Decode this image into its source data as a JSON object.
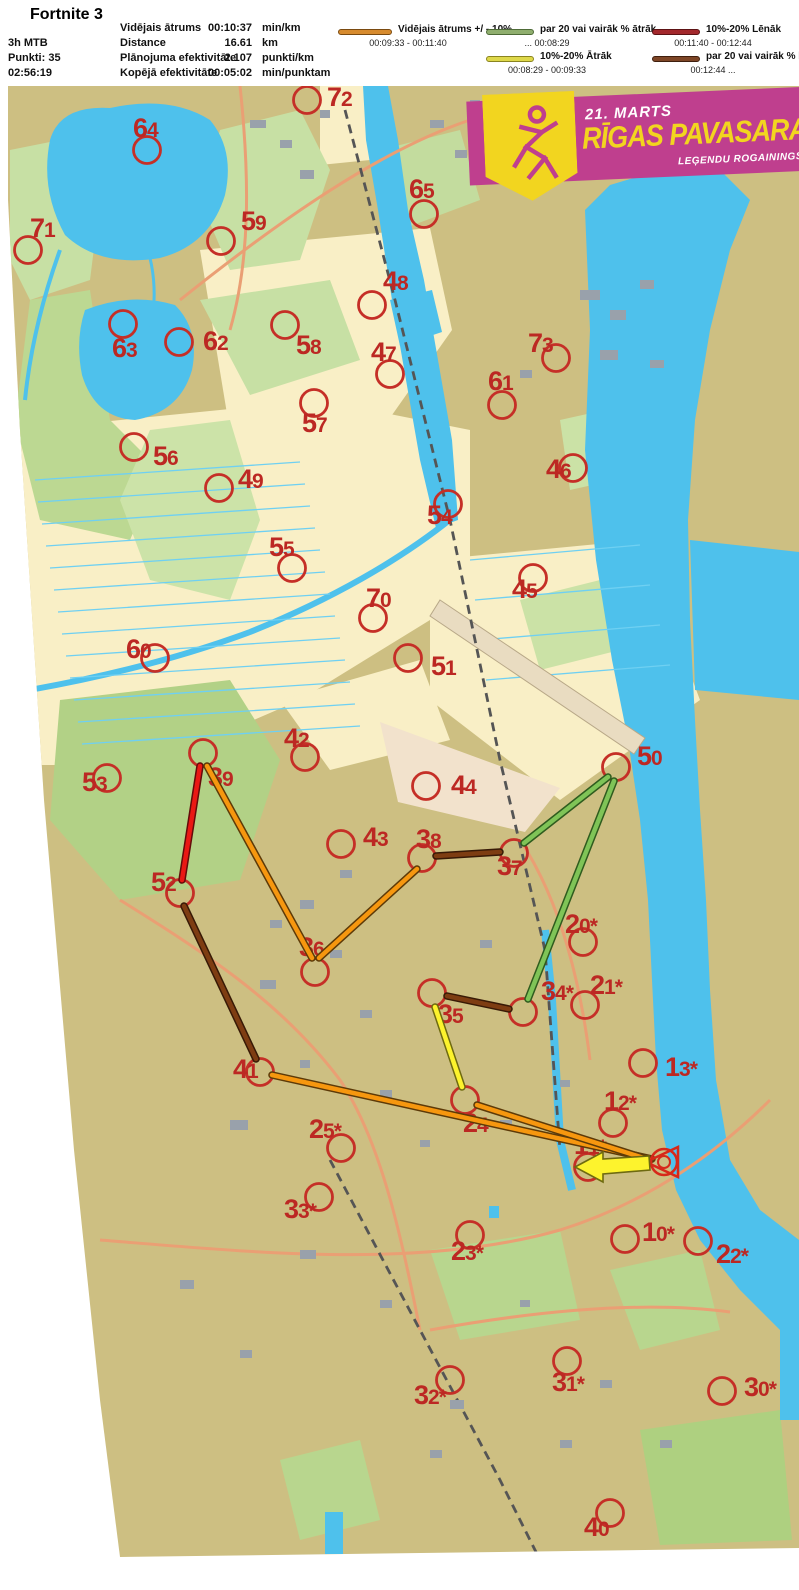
{
  "title": "Fortnite 3",
  "header": {
    "class": "3h MTB",
    "points": "Punkti: 35",
    "time": "02:56:19",
    "stats": [
      {
        "label": "Vidējais ātrums",
        "value": "00:10:37",
        "unit": "min/km"
      },
      {
        "label": "Distance",
        "value": "16.61",
        "unit": "km"
      },
      {
        "label": "Plānojuma efektivitāte",
        "value": "2.107",
        "unit": "punkti/km"
      },
      {
        "label": "Kopējā efektivitāte",
        "value": "00:05:02",
        "unit": "min/punktam"
      }
    ],
    "legend": [
      {
        "label": "Vidējais ātrums +/ - 10%",
        "range": "00:09:33   -   00:11:40",
        "color": "#d78b2e",
        "outline": "#7a4a10"
      },
      {
        "label": "par 20 vai vairāk % ātrāk",
        "range": "...    00:08:29",
        "color": "#8fae6e",
        "outline": "#4e6b37"
      },
      {
        "label": "10%-20% Ātrāk",
        "range": "00:08:29   -   00:09:33",
        "color": "#ded84a",
        "outline": "#8a8420"
      },
      {
        "label": "10%-20% Lēnāk",
        "range": "00:11:40   -   00:12:44",
        "color": "#a3282c",
        "outline": "#5d1214"
      },
      {
        "label": "par 20 vai vairāk % lēnāk",
        "range": "00:12:44    ...",
        "color": "#7d4526",
        "outline": "#3f1f0e"
      }
    ]
  },
  "banner": {
    "date": "21. MARTS",
    "title": "RĪGAS PAVASARA",
    "subtitle": "LEĢENDU ROGAININGS",
    "bg": "#bf3f8e",
    "accent": "#f2d51f"
  },
  "map": {
    "colors": {
      "control": "#c52f27",
      "label": "#bc2823"
    },
    "route_colors": {
      "avg": {
        "fill": "#f6970f",
        "edge": "#5d3a08"
      },
      "fast20": {
        "fill": "#7fc457",
        "edge": "#2f5c1e"
      },
      "fast10": {
        "fill": "#fdf32d",
        "edge": "#6e6a10"
      },
      "slow10": {
        "fill": "#ea1814",
        "edge": "#640b0a"
      },
      "slow20": {
        "fill": "#7e3d12",
        "edge": "#381a06"
      }
    },
    "controls": [
      {
        "id": "72",
        "cx": 307,
        "cy": 100,
        "lx": 327,
        "ly": 106
      },
      {
        "id": "64",
        "cx": 147,
        "cy": 150,
        "lx": 133,
        "ly": 137
      },
      {
        "id": "65",
        "cx": 424,
        "cy": 214,
        "lx": 409,
        "ly": 198
      },
      {
        "id": "71",
        "cx": 28,
        "cy": 250,
        "lx": 30,
        "ly": 237
      },
      {
        "id": "59",
        "cx": 221,
        "cy": 241,
        "lx": 241,
        "ly": 230
      },
      {
        "id": "48",
        "cx": 372,
        "cy": 305,
        "lx": 383,
        "ly": 290
      },
      {
        "id": "63",
        "cx": 123,
        "cy": 324,
        "lx": 112,
        "ly": 357
      },
      {
        "id": "62",
        "cx": 179,
        "cy": 342,
        "lx": 203,
        "ly": 350
      },
      {
        "id": "58",
        "cx": 285,
        "cy": 325,
        "lx": 296,
        "ly": 354
      },
      {
        "id": "47",
        "cx": 390,
        "cy": 374,
        "lx": 371,
        "ly": 361
      },
      {
        "id": "73",
        "cx": 556,
        "cy": 358,
        "lx": 528,
        "ly": 352
      },
      {
        "id": "61",
        "cx": 502,
        "cy": 405,
        "lx": 488,
        "ly": 390
      },
      {
        "id": "57",
        "cx": 314,
        "cy": 403,
        "lx": 302,
        "ly": 432
      },
      {
        "id": "56",
        "cx": 134,
        "cy": 447,
        "lx": 153,
        "ly": 465
      },
      {
        "id": "49",
        "cx": 219,
        "cy": 488,
        "lx": 238,
        "ly": 488
      },
      {
        "id": "46",
        "cx": 573,
        "cy": 468,
        "lx": 546,
        "ly": 478
      },
      {
        "id": "54",
        "cx": 448,
        "cy": 504,
        "lx": 427,
        "ly": 524
      },
      {
        "id": "55",
        "cx": 292,
        "cy": 568,
        "lx": 269,
        "ly": 556
      },
      {
        "id": "45",
        "cx": 533,
        "cy": 578,
        "lx": 512,
        "ly": 598
      },
      {
        "id": "70",
        "cx": 373,
        "cy": 618,
        "lx": 366,
        "ly": 607
      },
      {
        "id": "60",
        "cx": 155,
        "cy": 658,
        "lx": 126,
        "ly": 658
      },
      {
        "id": "51",
        "cx": 408,
        "cy": 658,
        "lx": 431,
        "ly": 675
      },
      {
        "id": "42",
        "cx": 305,
        "cy": 757,
        "lx": 284,
        "ly": 747
      },
      {
        "id": "50",
        "cx": 616,
        "cy": 767,
        "lx": 637,
        "ly": 765
      },
      {
        "id": "53",
        "cx": 107,
        "cy": 778,
        "lx": 82,
        "ly": 791
      },
      {
        "id": "39",
        "cx": 203,
        "cy": 753,
        "lx": 208,
        "ly": 786
      },
      {
        "id": "44",
        "cx": 426,
        "cy": 786,
        "lx": 451,
        "ly": 794
      },
      {
        "id": "43",
        "cx": 341,
        "cy": 844,
        "lx": 363,
        "ly": 846
      },
      {
        "id": "38",
        "cx": 422,
        "cy": 858,
        "lx": 416,
        "ly": 848
      },
      {
        "id": "37",
        "cx": 514,
        "cy": 853,
        "lx": 497,
        "ly": 875
      },
      {
        "id": "52",
        "cx": 180,
        "cy": 893,
        "lx": 151,
        "ly": 891
      },
      {
        "id": "20*",
        "cx": 583,
        "cy": 942,
        "lx": 565,
        "ly": 933
      },
      {
        "id": "36",
        "cx": 315,
        "cy": 972,
        "lx": 299,
        "ly": 956
      },
      {
        "id": "21*",
        "cx": 585,
        "cy": 1005,
        "lx": 590,
        "ly": 994
      },
      {
        "id": "34*",
        "cx": 523,
        "cy": 1012,
        "lx": 541,
        "ly": 1000
      },
      {
        "id": "35",
        "cx": 432,
        "cy": 993,
        "lx": 438,
        "ly": 1023
      },
      {
        "id": "13*",
        "cx": 643,
        "cy": 1063,
        "lx": 665,
        "ly": 1076
      },
      {
        "id": "41",
        "cx": 260,
        "cy": 1072,
        "lx": 233,
        "ly": 1078
      },
      {
        "id": "12*",
        "cx": 613,
        "cy": 1123,
        "lx": 604,
        "ly": 1110
      },
      {
        "id": "25*",
        "cx": 341,
        "cy": 1148,
        "lx": 309,
        "ly": 1138
      },
      {
        "id": "24",
        "cx": 465,
        "cy": 1100,
        "lx": 463,
        "ly": 1132
      },
      {
        "id": "11*",
        "cx": 588,
        "cy": 1167,
        "lx": 574,
        "ly": 1154
      },
      {
        "id": "33*",
        "cx": 319,
        "cy": 1197,
        "lx": 284,
        "ly": 1218
      },
      {
        "id": "23*",
        "cx": 470,
        "cy": 1235,
        "lx": 451,
        "ly": 1260
      },
      {
        "id": "10*",
        "cx": 625,
        "cy": 1239,
        "lx": 642,
        "ly": 1241
      },
      {
        "id": "22*",
        "cx": 698,
        "cy": 1241,
        "lx": 716,
        "ly": 1263
      },
      {
        "id": "32*",
        "cx": 450,
        "cy": 1380,
        "lx": 414,
        "ly": 1404
      },
      {
        "id": "31*",
        "cx": 567,
        "cy": 1361,
        "lx": 552,
        "ly": 1391
      },
      {
        "id": "30*",
        "cx": 722,
        "cy": 1391,
        "lx": 744,
        "ly": 1396
      },
      {
        "id": "40",
        "cx": 610,
        "cy": 1513,
        "lx": 584,
        "ly": 1536
      }
    ],
    "route": {
      "segments": [
        {
          "x1": 200,
          "y1": 766,
          "x2": 182,
          "y2": 880,
          "cat": "slow10"
        },
        {
          "x1": 184,
          "y1": 906,
          "x2": 256,
          "y2": 1059,
          "cat": "slow20"
        },
        {
          "x1": 272,
          "y1": 1075,
          "x2": 652,
          "y2": 1159,
          "cat": "avg"
        },
        {
          "x1": 207,
          "y1": 766,
          "x2": 312,
          "y2": 958,
          "cat": "avg"
        },
        {
          "x1": 319,
          "y1": 958,
          "x2": 417,
          "y2": 869,
          "cat": "avg"
        },
        {
          "x1": 436,
          "y1": 856,
          "x2": 500,
          "y2": 852,
          "cat": "slow20"
        },
        {
          "x1": 524,
          "y1": 843,
          "x2": 608,
          "y2": 777,
          "cat": "fast20"
        },
        {
          "x1": 614,
          "y1": 781,
          "x2": 528,
          "y2": 999,
          "cat": "fast20"
        },
        {
          "x1": 509,
          "y1": 1009,
          "x2": 447,
          "y2": 996,
          "cat": "slow20"
        },
        {
          "x1": 435,
          "y1": 1007,
          "x2": 462,
          "y2": 1087,
          "cat": "fast10"
        },
        {
          "x1": 477,
          "y1": 1105,
          "x2": 650,
          "y2": 1160,
          "cat": "avg"
        }
      ],
      "arrow": {
        "cat": "fast10",
        "points": "575,1167 603,1152 603,1159 649,1156 650,1170 603,1174 603,1182"
      },
      "finish": {
        "cx": 664,
        "cy": 1162
      }
    }
  }
}
